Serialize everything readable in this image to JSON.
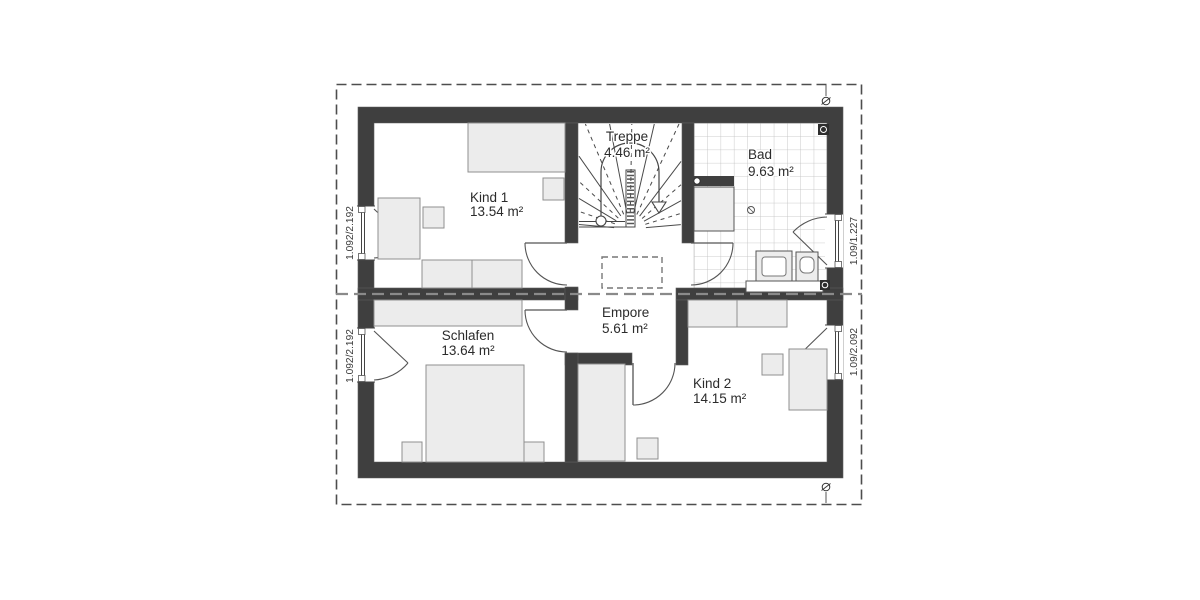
{
  "rooms": [
    {
      "name": "Kind 1",
      "area": "13.54 m²"
    },
    {
      "name": "Treppe",
      "area": "4.46 m²"
    },
    {
      "name": "Bad",
      "area": "9.63 m²"
    },
    {
      "name": "Schlafen",
      "area": "13.64 m²"
    },
    {
      "name": "Empore",
      "area": "5.61 m²"
    },
    {
      "name": "Kind 2",
      "area": "14.15 m²"
    }
  ],
  "window_dimensions": {
    "left_top": "1.092/2.192",
    "left_bottom": "1.092/2.192",
    "right_top": "1.09/1.227",
    "right_bottom": "1.09/2.092"
  },
  "colors": {
    "wall": "#3f3f3f",
    "furniture_fill": "#ececec",
    "tile_line": "#bdbdbd",
    "background": "#ffffff"
  }
}
